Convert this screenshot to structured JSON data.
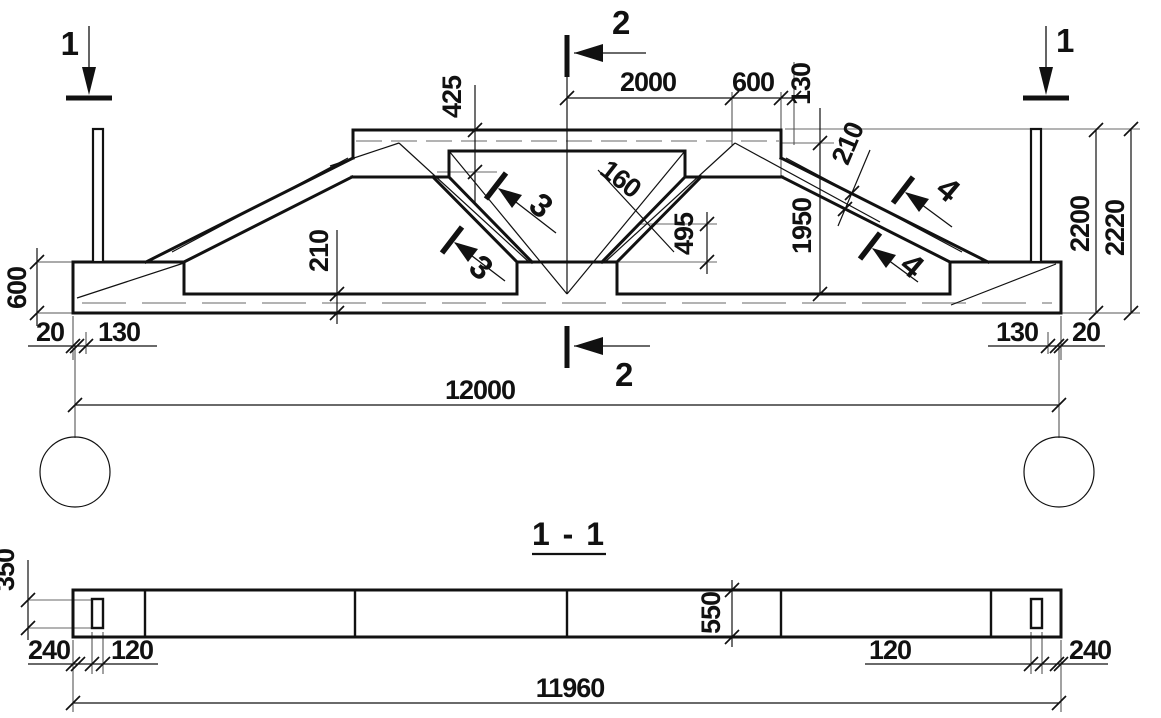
{
  "drawing": {
    "section_title": "1 - 1",
    "markers": {
      "s1": "1",
      "s2": "2",
      "s3": "3",
      "s4": "4"
    },
    "elevation_dims": {
      "slab_425": "425",
      "top_2000": "2000",
      "top_600": "600",
      "top_130": "130",
      "diag_160": "160",
      "node_495": "495",
      "height_1950": "1950",
      "slope_210": "210",
      "chord_210": "210",
      "end_600": "600",
      "height_2200": "2200",
      "height_2220": "2220",
      "left_20": "20",
      "left_130": "130",
      "right_130": "130",
      "right_20": "20",
      "span_12000": "12000"
    },
    "section_dims": {
      "hole_350": "350",
      "depth_550": "550",
      "left_240": "240",
      "left_120": "120",
      "right_120": "120",
      "right_240": "240",
      "length_11960": "11960"
    }
  }
}
